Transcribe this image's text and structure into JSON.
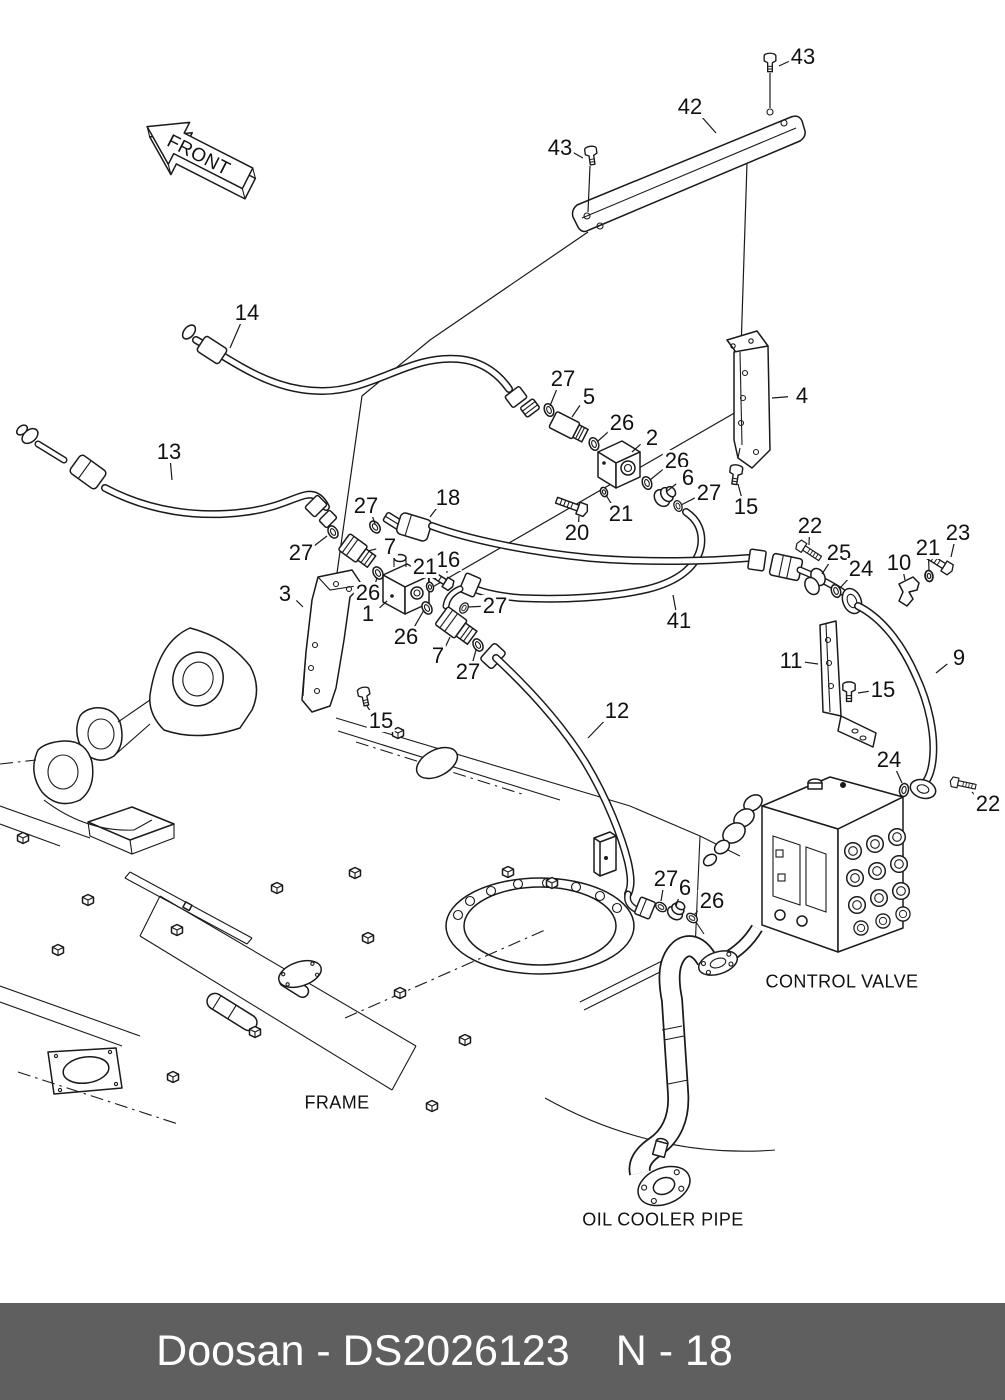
{
  "doc": {
    "type": "parts-diagram",
    "ink_color": "#1a1a1a",
    "paper_color": "#ffffff"
  },
  "labels": {
    "front": "FRONT",
    "control_valve": "CONTROL VALVE",
    "frame": "FRAME",
    "oil_cooler_pipe": "OIL COOLER PIPE"
  },
  "footer": {
    "brand_doc": "Doosan - DS2026123",
    "page": "N - 18",
    "background": "#5f5f5f",
    "text_color": "#ffffff"
  },
  "callouts": [
    {
      "t": "43",
      "x": 803,
      "y": 57,
      "lx": 779,
      "ly": 66
    },
    {
      "t": "42",
      "x": 690,
      "y": 107,
      "lx": 716,
      "ly": 133
    },
    {
      "t": "43",
      "x": 560,
      "y": 148,
      "lx": 583,
      "ly": 158
    },
    {
      "t": "14",
      "x": 247,
      "y": 313,
      "lx": 230,
      "ly": 348
    },
    {
      "t": "27",
      "x": 563,
      "y": 379,
      "lx": 550,
      "ly": 406
    },
    {
      "t": "5",
      "x": 589,
      "y": 397,
      "lx": 572,
      "ly": 417
    },
    {
      "t": "4",
      "x": 802,
      "y": 396,
      "lx": 772,
      "ly": 398
    },
    {
      "t": "26",
      "x": 622,
      "y": 423,
      "lx": 598,
      "ly": 441
    },
    {
      "t": "2",
      "x": 652,
      "y": 438,
      "lx": 632,
      "ly": 452
    },
    {
      "t": "13",
      "x": 169,
      "y": 452,
      "lx": 172,
      "ly": 480
    },
    {
      "t": "26",
      "x": 677,
      "y": 461,
      "lx": 650,
      "ly": 480
    },
    {
      "t": "6",
      "x": 688,
      "y": 478,
      "lx": 666,
      "ly": 492
    },
    {
      "t": "27",
      "x": 709,
      "y": 493,
      "lx": 681,
      "ly": 505
    },
    {
      "t": "18",
      "x": 448,
      "y": 498,
      "lx": 430,
      "ly": 517
    },
    {
      "t": "27",
      "x": 366,
      "y": 506,
      "lx": 375,
      "ly": 524
    },
    {
      "t": "15",
      "x": 746,
      "y": 507,
      "lx": 738,
      "ly": 484
    },
    {
      "t": "21",
      "x": 621,
      "y": 514,
      "lx": 606,
      "ly": 495
    },
    {
      "t": "22",
      "x": 810,
      "y": 526,
      "lx": 809,
      "ly": 545
    },
    {
      "t": "23",
      "x": 958,
      "y": 533,
      "lx": 951,
      "ly": 557
    },
    {
      "t": "20",
      "x": 577,
      "y": 533,
      "lx": 579,
      "ly": 516
    },
    {
      "t": "7",
      "x": 390,
      "y": 547,
      "lx": 368,
      "ly": 551
    },
    {
      "t": "21",
      "x": 928,
      "y": 548,
      "lx": 929,
      "ly": 571
    },
    {
      "t": "27",
      "x": 301,
      "y": 553,
      "lx": 327,
      "ly": 536
    },
    {
      "t": "25",
      "x": 839,
      "y": 553,
      "lx": 822,
      "ly": 574
    },
    {
      "t": "16",
      "x": 448,
      "y": 560,
      "lx": 447,
      "ly": 573
    },
    {
      "t": "10",
      "x": 899,
      "y": 563,
      "lx": 905,
      "ly": 580
    },
    {
      "t": "21",
      "x": 425,
      "y": 567,
      "lx": 429,
      "ly": 583
    },
    {
      "t": "24",
      "x": 861,
      "y": 569,
      "lx": 840,
      "ly": 588
    },
    {
      "t": "3",
      "x": 285,
      "y": 594,
      "lx": 303,
      "ly": 607
    },
    {
      "t": "26",
      "x": 368,
      "y": 593,
      "lx": 377,
      "ly": 578
    },
    {
      "t": "27",
      "x": 495,
      "y": 606,
      "lx": 468,
      "ly": 607
    },
    {
      "t": "1",
      "x": 368,
      "y": 614,
      "lx": 387,
      "ly": 601
    },
    {
      "t": "41",
      "x": 679,
      "y": 621,
      "lx": 673,
      "ly": 595
    },
    {
      "t": "26",
      "x": 406,
      "y": 637,
      "lx": 424,
      "ly": 610
    },
    {
      "t": "7",
      "x": 438,
      "y": 656,
      "lx": 450,
      "ly": 637
    },
    {
      "t": "11",
      "x": 791,
      "y": 661,
      "lx": 818,
      "ly": 664
    },
    {
      "t": "9",
      "x": 959,
      "y": 658,
      "lx": 936,
      "ly": 673
    },
    {
      "t": "27",
      "x": 468,
      "y": 672,
      "lx": 476,
      "ly": 650
    },
    {
      "t": "15",
      "x": 883,
      "y": 690,
      "lx": 858,
      "ly": 693
    },
    {
      "t": "12",
      "x": 617,
      "y": 711,
      "lx": 588,
      "ly": 738
    },
    {
      "t": "15",
      "x": 381,
      "y": 721,
      "lx": 367,
      "ly": 706
    },
    {
      "t": "24",
      "x": 889,
      "y": 760,
      "lx": 902,
      "ly": 783
    },
    {
      "t": "22",
      "x": 988,
      "y": 804,
      "lx": 972,
      "ly": 792
    },
    {
      "t": "27",
      "x": 666,
      "y": 879,
      "lx": 661,
      "ly": 901
    },
    {
      "t": "6",
      "x": 685,
      "y": 888,
      "lx": 676,
      "ly": 906
    },
    {
      "t": "26",
      "x": 712,
      "y": 901,
      "lx": 694,
      "ly": 915
    }
  ]
}
